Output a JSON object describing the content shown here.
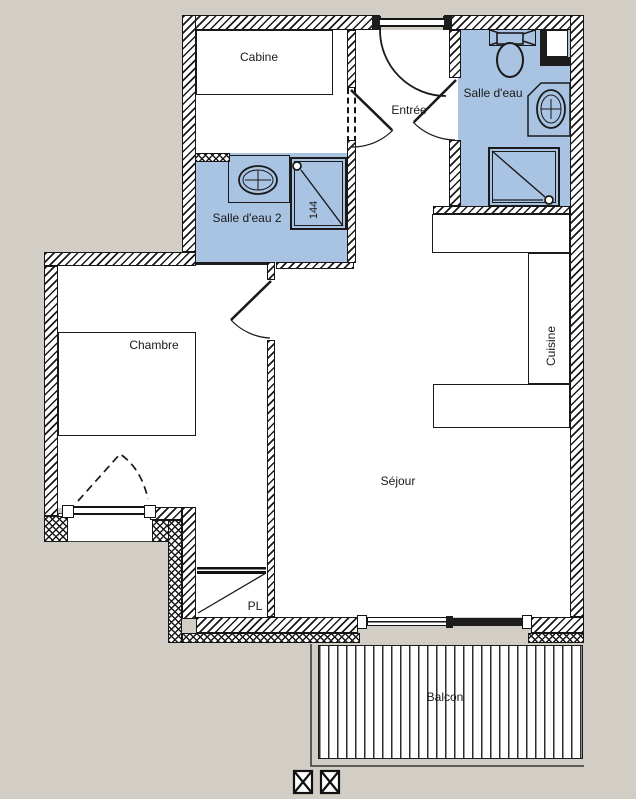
{
  "plan": {
    "type": "apartment-floor-plan",
    "colors": {
      "background": "#d2cec6",
      "wet_room_fill": "#a9c3e3",
      "wall_line": "#1a1a1a",
      "floor_fill": "#ffffff"
    },
    "rooms": {
      "cabine": {
        "label": "Cabine"
      },
      "entree": {
        "label": "Entrée"
      },
      "salle_deau": {
        "label": "Salle d'eau"
      },
      "salle_deau2": {
        "label": "Salle d'eau 2"
      },
      "chambre": {
        "label": "Chambre"
      },
      "cuisine": {
        "label": "Cuisine"
      },
      "sejour": {
        "label": "Séjour"
      },
      "placard": {
        "label": "PL"
      },
      "balcon": {
        "label": "Balcon"
      }
    },
    "annotations": {
      "shower_dimension": "144"
    }
  }
}
